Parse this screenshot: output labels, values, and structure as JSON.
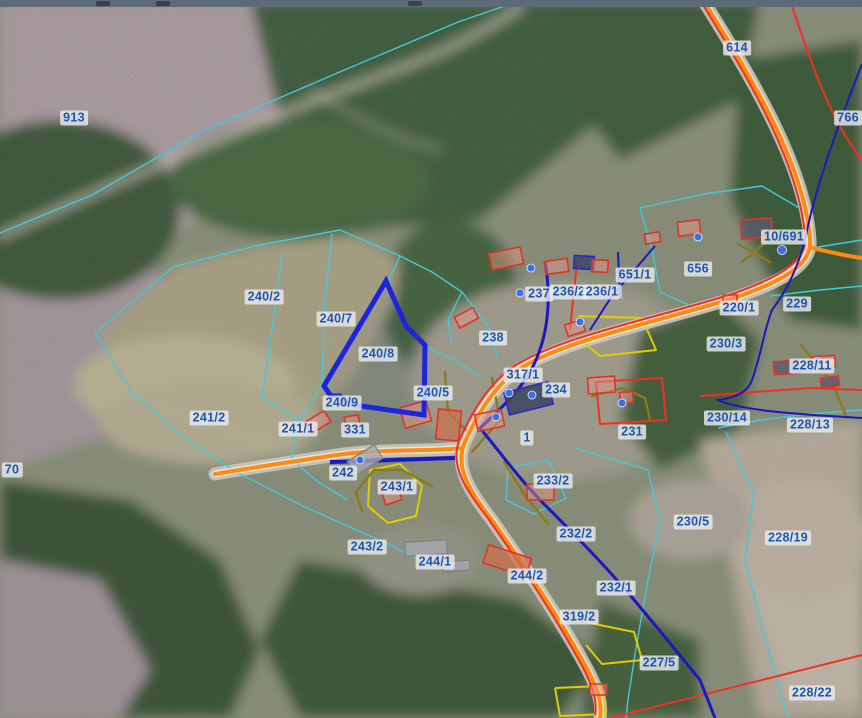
{
  "map": {
    "kind": "cadastral parcel overlay on aerial orthophoto",
    "highlighted_parcel": "240/8",
    "colors": {
      "label_text": "#1c56b0",
      "label_bg": "rgba(233,234,236,0.82)",
      "highlight": "#1d24dd",
      "boundary": "#45c8da",
      "road_orange": "#ff8a12",
      "line_red": "#f23022",
      "line_navy": "#1a18c0",
      "line_olive": "#8a7a1a",
      "line_yellow": "#e0cc00",
      "building_stroke": "#e03328",
      "building_fill": "rgba(238,150,138,0.45)",
      "address_dot": "#3d6fe0"
    },
    "labels": [
      {
        "text": "913",
        "x": 74,
        "y": 118
      },
      {
        "text": "240/2",
        "x": 264,
        "y": 297
      },
      {
        "text": "240/7",
        "x": 336,
        "y": 319
      },
      {
        "text": "240/8",
        "x": 378,
        "y": 354
      },
      {
        "text": "240/5",
        "x": 433,
        "y": 393
      },
      {
        "text": "240/9",
        "x": 342,
        "y": 403
      },
      {
        "text": "241/2",
        "x": 209,
        "y": 418
      },
      {
        "text": "241/1",
        "x": 298,
        "y": 429
      },
      {
        "text": "331",
        "x": 355,
        "y": 430
      },
      {
        "text": "242",
        "x": 343,
        "y": 473
      },
      {
        "text": "243/1",
        "x": 397,
        "y": 487
      },
      {
        "text": "243/2",
        "x": 367,
        "y": 547
      },
      {
        "text": "244/1",
        "x": 435,
        "y": 562
      },
      {
        "text": "244/2",
        "x": 527,
        "y": 576
      },
      {
        "text": "237",
        "x": 539,
        "y": 294
      },
      {
        "text": "236/2",
        "x": 569,
        "y": 292
      },
      {
        "text": "236/1",
        "x": 602,
        "y": 292
      },
      {
        "text": "238",
        "x": 493,
        "y": 338
      },
      {
        "text": "651/1",
        "x": 635,
        "y": 275
      },
      {
        "text": "656",
        "x": 698,
        "y": 269
      },
      {
        "text": "10/691",
        "x": 784,
        "y": 237
      },
      {
        "text": "614",
        "x": 737,
        "y": 48
      },
      {
        "text": "766",
        "x": 848,
        "y": 118
      },
      {
        "text": "220/1",
        "x": 739,
        "y": 308
      },
      {
        "text": "229",
        "x": 797,
        "y": 304
      },
      {
        "text": "230/3",
        "x": 726,
        "y": 344
      },
      {
        "text": "228/11",
        "x": 812,
        "y": 366
      },
      {
        "text": "230/14",
        "x": 727,
        "y": 418
      },
      {
        "text": "228/13",
        "x": 810,
        "y": 425
      },
      {
        "text": "231",
        "x": 632,
        "y": 432
      },
      {
        "text": "317/1",
        "x": 523,
        "y": 375
      },
      {
        "text": "234",
        "x": 556,
        "y": 390
      },
      {
        "text": "1",
        "x": 527,
        "y": 438
      },
      {
        "text": "233/2",
        "x": 553,
        "y": 481
      },
      {
        "text": "232/2",
        "x": 576,
        "y": 534
      },
      {
        "text": "230/5",
        "x": 693,
        "y": 522
      },
      {
        "text": "228/19",
        "x": 788,
        "y": 538
      },
      {
        "text": "232/1",
        "x": 616,
        "y": 588
      },
      {
        "text": "319/2",
        "x": 579,
        "y": 617
      },
      {
        "text": "227/5",
        "x": 659,
        "y": 663
      },
      {
        "text": "228/22",
        "x": 812,
        "y": 693
      },
      {
        "text": "70",
        "x": 12,
        "y": 470
      }
    ]
  }
}
